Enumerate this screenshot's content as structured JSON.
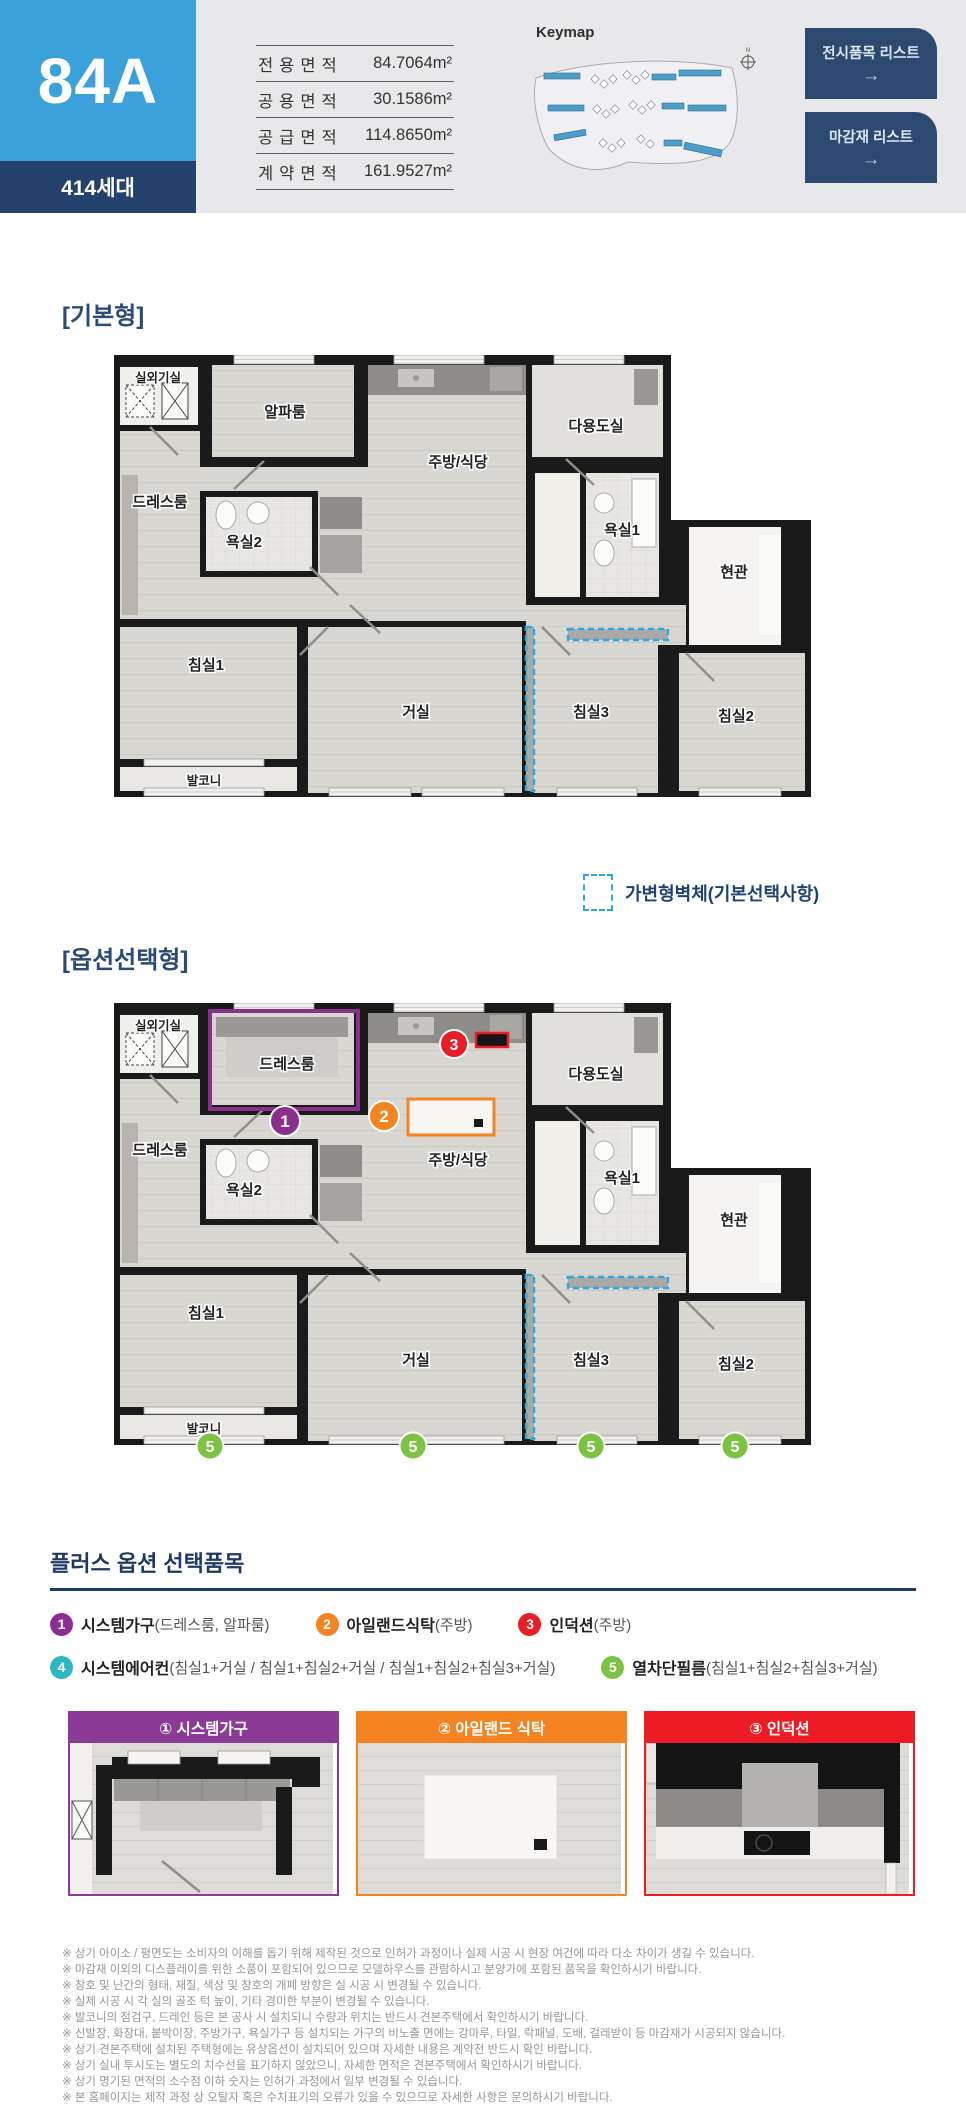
{
  "header": {
    "unit_name": "84A",
    "unit_count": "414세대",
    "keymap_label": "Keymap",
    "compass": "N",
    "area_table": {
      "rows": [
        {
          "label": "전용면적",
          "value": "84.7064m²"
        },
        {
          "label": "공용면적",
          "value": "30.1586m²"
        },
        {
          "label": "공급면적",
          "value": "114.8650m²"
        },
        {
          "label": "계약면적",
          "value": "161.9527m²"
        }
      ]
    },
    "buttons": [
      {
        "label": "전시품목 리스트",
        "arrow": "→"
      },
      {
        "label": "마감재 리스트",
        "arrow": "→"
      }
    ]
  },
  "sections": {
    "basic_label": "[기본형]",
    "option_label": "[옵션선택형]"
  },
  "variable_wall_legend": "가변형벽체(기본선택사항)",
  "rooms": {
    "outdoor": "실외기실",
    "alpha": "알파룸",
    "kitchen": "주방/식당",
    "utility": "다용도실",
    "dress": "드레스룸",
    "bath2": "욕실2",
    "bath1": "욕실1",
    "entry": "현관",
    "bed1": "침실1",
    "living": "거실",
    "bed3": "침실3",
    "bed2": "침실2",
    "balcony": "발코니"
  },
  "colors": {
    "accent_blue": "#3BA1DB",
    "navy": "#24426B",
    "button_navy": "#2C4A70",
    "dashed_blue": "#2AA9E1",
    "purple": "#8B2F8F",
    "orange": "#F5831F",
    "red": "#EC1C24",
    "teal": "#2BB7C4",
    "green": "#7DC242"
  },
  "plus_options": {
    "title": "플러스 옵션 선택품목",
    "items": [
      {
        "num": "1",
        "color": "#8B2F8F",
        "name": "시스템가구",
        "detail": "(드레스룸, 알파룸)"
      },
      {
        "num": "2",
        "color": "#F5831F",
        "name": "아일랜드식탁",
        "detail": "(주방)"
      },
      {
        "num": "3",
        "color": "#EC1C24",
        "name": "인덕션",
        "detail": "(주방)"
      },
      {
        "num": "4",
        "color": "#2BB7C4",
        "name": "시스템에어컨",
        "detail": "(침실1+거실 / 침실1+침실2+거실 / 침실1+침실2+침실3+거실)"
      },
      {
        "num": "5",
        "color": "#7DC242",
        "name": "열차단필름",
        "detail": "(침실1+침실2+침실3+거실)"
      }
    ],
    "cards": [
      {
        "title": "① 시스템가구",
        "color": "#8B3A96"
      },
      {
        "title": "② 아일랜드 식탁",
        "color": "#F5831F"
      },
      {
        "title": "③ 인덕션",
        "color": "#ED1C24"
      }
    ]
  },
  "notes": [
    "※ 상기 아이소 / 평면도는 소비자의 이해를 돕기 위해 제작된 것으로 인허가 과정이나 실제 시공 시 현장 여건에 따라 다소 차이가 생길 수 있습니다.",
    "※ 마감재 이외의 디스플레이를 위한 소품이 포함되어 있으므로 모델하우스를 관람하시고 분양가에 포함된 품목을 확인하시기 바랍니다.",
    "※ 창호 및 난간의 형태, 재질, 색상 및 창호의 개폐 방향은 실 시공 시 변경될 수 있습니다.",
    "※ 실제 시공 시 각 실의 골조 턱 높이, 기타 경미한 부분이 변경될 수 있습니다.",
    "※ 발코니의 점검구, 드레인 등은 본 공사 시 설치되니 수량과 위치는 반드시 견본주택에서 확인하시기 바랍니다.",
    "※ 신발장, 화장대, 붙박이장, 주방가구, 욕실가구 등 설치되는 가구의 비노출 면에는 강마루, 타일, 락패널, 도배, 걸레받이 등 마감재가 시공되지 않습니다.",
    "※ 상기 견본주택에 설치된 주택형에는 유상옵션이 설치되어 있으며 자세한 내용은 계약전 반드시 확인 바랍니다.",
    "※ 상기 실내 투시도는 별도의 치수선을 표기하지 않았으니, 자세한 면적은 견본주택에서 확인하시기 바랍니다.",
    "※ 상기 명기된 면적의 소수점 이하 숫자는 인허가 과정에서 일부 변경될 수 있습니다.",
    "※ 본 홈페이지는 제작 과정 상 오탈자 혹은 수치표기의 오류가 있을 수 있으므로 자세한 사항은 문의하시기 바랍니다."
  ]
}
